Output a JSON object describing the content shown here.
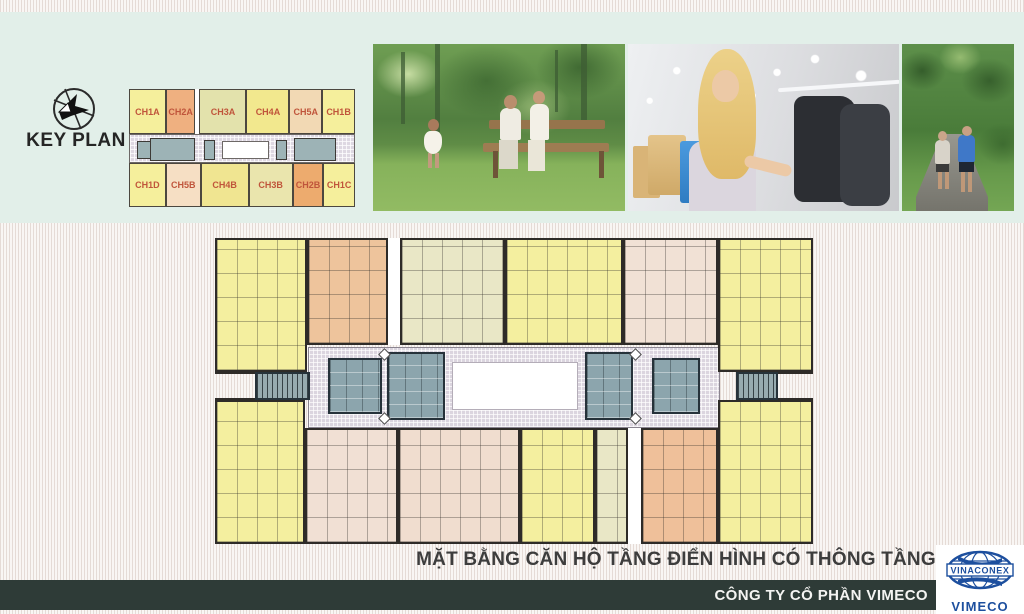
{
  "keyplan": {
    "title": "KEY PLAN",
    "units_top": [
      {
        "label": "CH1A",
        "color": "#f5ef9c",
        "w": 16.3
      },
      {
        "label": "CH2A",
        "color": "#efb080",
        "w": 13.1
      },
      {
        "gap": true,
        "color": "#ffffff",
        "w": 1.8
      },
      {
        "label": "CH3A",
        "color": "#e3e2ac",
        "w": 20.8
      },
      {
        "label": "CH4A",
        "color": "#f2e88e",
        "w": 19.0
      },
      {
        "label": "CH5A",
        "color": "#f2d9b4",
        "w": 14.5
      },
      {
        "label": "CH1B",
        "color": "#f5ef9c",
        "w": 14.5
      }
    ],
    "units_bottom": [
      {
        "label": "CH1D",
        "color": "#f5ef9c",
        "w": 16.3
      },
      {
        "label": "CH5B",
        "color": "#f6dfc4",
        "w": 15.4
      },
      {
        "label": "CH4B",
        "color": "#f0e591",
        "w": 21.3
      },
      {
        "label": "CH3B",
        "color": "#eae5ad",
        "w": 19.4
      },
      {
        "label": "CH2B",
        "color": "#edab6e",
        "w": 13.6
      },
      {
        "label": "CH1C",
        "color": "#f5ef9c",
        "w": 14.0
      }
    ]
  },
  "photos": [
    {
      "name": "family-in-park"
    },
    {
      "name": "woman-shopping"
    },
    {
      "name": "couple-walking-in-park"
    }
  ],
  "floorplan": {
    "elements": [
      {
        "t": "corridor",
        "x": 93,
        "y": 115,
        "w": 412,
        "h": 81
      },
      {
        "t": "void",
        "x": 237,
        "y": 130,
        "w": 126,
        "h": 48
      },
      {
        "t": "core",
        "x": 113,
        "y": 126,
        "w": 54,
        "h": 56
      },
      {
        "t": "core",
        "x": 172,
        "y": 120,
        "w": 58,
        "h": 68
      },
      {
        "t": "core",
        "x": 370,
        "y": 120,
        "w": 48,
        "h": 68
      },
      {
        "t": "core",
        "x": 437,
        "y": 126,
        "w": 48,
        "h": 56
      },
      {
        "t": "stair",
        "x": 40,
        "y": 140,
        "w": 55,
        "h": 28
      },
      {
        "t": "stair",
        "x": 521,
        "y": 140,
        "w": 42,
        "h": 28
      },
      {
        "t": "diamond",
        "x": 165,
        "y": 118
      },
      {
        "t": "diamond",
        "x": 165,
        "y": 182
      },
      {
        "t": "diamond",
        "x": 416,
        "y": 118
      },
      {
        "t": "diamond",
        "x": 416,
        "y": 182
      },
      {
        "t": "unit",
        "x": 0,
        "y": 6,
        "w": 92,
        "h": 134,
        "c": "#f4ef9f"
      },
      {
        "t": "unit",
        "x": 92,
        "y": 6,
        "w": 81,
        "h": 107,
        "c": "#eec49c"
      },
      {
        "t": "gap",
        "x": 173,
        "y": 6,
        "w": 12,
        "h": 107
      },
      {
        "t": "unit",
        "x": 185,
        "y": 6,
        "w": 105,
        "h": 107,
        "c": "#e9e7c6"
      },
      {
        "t": "unit",
        "x": 290,
        "y": 6,
        "w": 118,
        "h": 107,
        "c": "#f4ef9f"
      },
      {
        "t": "unit",
        "x": 408,
        "y": 6,
        "w": 95,
        "h": 107,
        "c": "#f1e1d5"
      },
      {
        "t": "unit",
        "x": 503,
        "y": 6,
        "w": 95,
        "h": 134,
        "c": "#f4ef9f"
      },
      {
        "t": "unit",
        "x": 0,
        "y": 168,
        "w": 90,
        "h": 144,
        "c": "#f4ef9f"
      },
      {
        "t": "unit",
        "x": 90,
        "y": 196,
        "w": 93,
        "h": 116,
        "c": "#f1e0d4"
      },
      {
        "t": "unit",
        "x": 183,
        "y": 196,
        "w": 122,
        "h": 116,
        "c": "#f0ddcf"
      },
      {
        "t": "unit",
        "x": 305,
        "y": 196,
        "w": 75,
        "h": 116,
        "c": "#f4ef9f"
      },
      {
        "t": "unit",
        "x": 380,
        "y": 196,
        "w": 33,
        "h": 116,
        "c": "#e9e7c6"
      },
      {
        "t": "gap",
        "x": 413,
        "y": 196,
        "w": 13,
        "h": 116
      },
      {
        "t": "unit",
        "x": 426,
        "y": 196,
        "w": 77,
        "h": 116,
        "c": "#efc09a"
      },
      {
        "t": "unit",
        "x": 503,
        "y": 168,
        "w": 95,
        "h": 144,
        "c": "#f4ef9f"
      },
      {
        "t": "rail",
        "x": 0,
        "y": 139,
        "w": 40,
        "h": 3
      },
      {
        "t": "rail",
        "x": 0,
        "y": 166,
        "w": 40,
        "h": 3
      },
      {
        "t": "rail",
        "x": 563,
        "y": 139,
        "w": 35,
        "h": 3
      },
      {
        "t": "rail",
        "x": 563,
        "y": 166,
        "w": 35,
        "h": 3
      }
    ]
  },
  "caption": "MẶT BẰNG CĂN HỘ TẦNG ĐIỂN HÌNH CÓ THÔNG TẦNG",
  "footer": {
    "company": "CÔNG TY CỔ PHẦN VIMECO"
  },
  "logo": {
    "brand": "VINACONEX",
    "subsidiary": "VIMECO"
  },
  "colors": {
    "accent_label": "#c0553b",
    "panel_mint": "#e2efe9",
    "footer_bar": "#2e3b37",
    "core_gray": "#8ca5ad",
    "wall": "#2e2b28",
    "logo_blue": "#1d4f9e"
  }
}
